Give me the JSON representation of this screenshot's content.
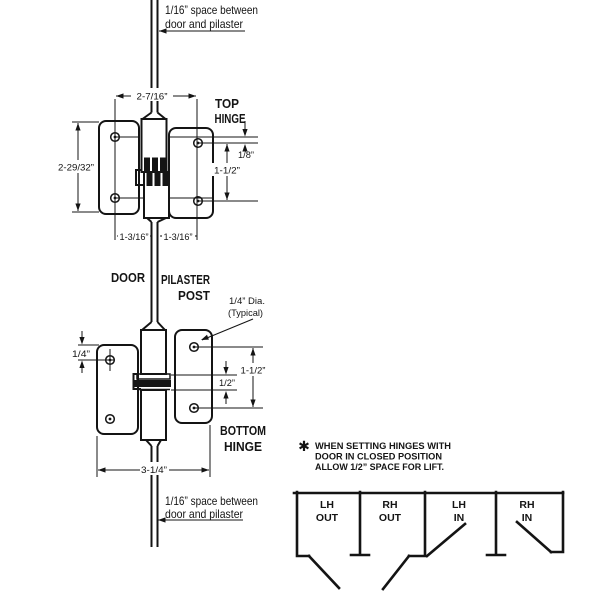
{
  "notes": {
    "top_gap": {
      "line1": "1/16” space between",
      "line2": "door and pilaster"
    },
    "bottom_gap": {
      "line1": "1/16” space between",
      "line2": "door and pilaster"
    },
    "hole_dia": {
      "line1": "1/4” Dia.",
      "line2": "(Typical)"
    },
    "lift": {
      "symbol": "✱",
      "line1": "WHEN SETTING HINGES WITH",
      "line2": "DOOR IN CLOSED POSITION",
      "line3": "ALLOW 1/2” SPACE FOR LIFT."
    }
  },
  "labels": {
    "top_hinge": {
      "line1": "TOP",
      "line2": "HINGE"
    },
    "bottom_hinge": {
      "line1": "BOTTOM",
      "line2": "HINGE"
    },
    "door": "DOOR",
    "pilaster": {
      "line1": "PILASTER",
      "line2": "POST"
    }
  },
  "dimensions": {
    "top_hole_span": "2-7/16”",
    "top_plate_height": "2-29/32”",
    "leaf_offset": "1/8”",
    "top_hole_spacing": "1-1/2”",
    "door_hole_to_center": "1-3/16”",
    "pilaster_hole_to_center": "1-3/16”",
    "bottom_plate_inset": "1/4”",
    "pin_gap": "1/2”",
    "bottom_hole_spacing": "1-1/2”",
    "bottom_hinge_width": "3-1/4”"
  },
  "stalls": [
    {
      "line1": "LH",
      "line2": "OUT"
    },
    {
      "line1": "RH",
      "line2": "OUT"
    },
    {
      "line1": "LH",
      "line2": "IN"
    },
    {
      "line1": "RH",
      "line2": "IN"
    }
  ],
  "colors": {
    "ink": "#141414",
    "background": "#ffffff"
  }
}
